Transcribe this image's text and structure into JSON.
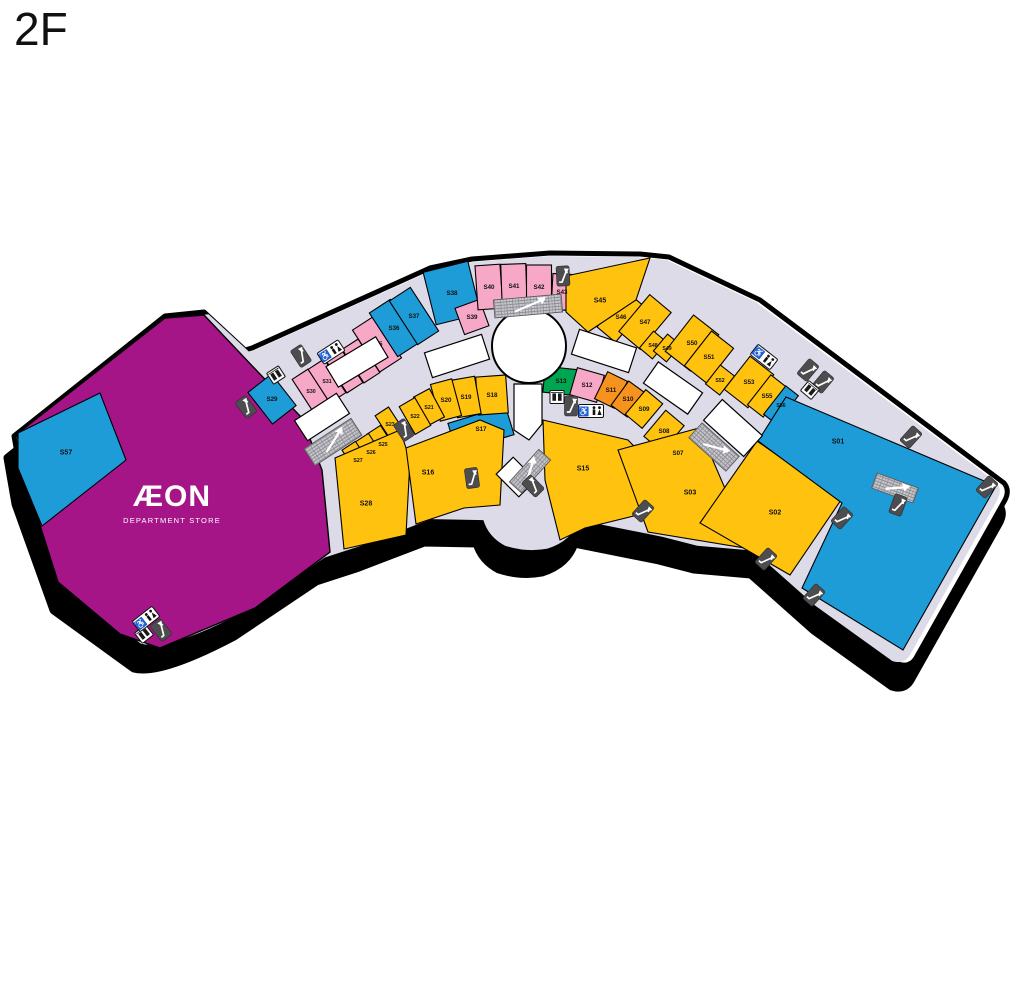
{
  "title": "2F",
  "anchor": {
    "name": "ÆON",
    "subname": "DEPARTMENT STORE",
    "label_x": 172,
    "label_y": 506
  },
  "colors": {
    "anchor": "#A51588",
    "yellow": "#FFC20E",
    "pink": "#F7A8C6",
    "blue": "#1E9CD8",
    "orange": "#F6921E",
    "green": "#00A551",
    "walkway": "#DCDBE7",
    "kiosk": "#FFFFFF",
    "outline": "#000000",
    "icon_dark": "#4D4D4F",
    "hatch_bg": "#C7C7CC",
    "hatch_line": "#8E8E96"
  },
  "outline_path": "M165,316 L204,312 L245,350 L252,348 L390,286 L430,268 L472,259 L550,253 L640,254 L669,257 L760,300 L1004,483 Q1010,490 1005,500 L916,658 Q910,668 898,664 L820,608 L757,552 L700,547 L665,538 L580,521 Q573,542 548,550 Q527,554 505,547 Q488,538 483,521 L430,520 L362,546 L322,559 L240,614 Q166,653 140,646 L60,588 L22,482 L14,436 Z",
  "anchor_poly": "204,315 258,372 302,418 322,470 330,552 255,608 160,648 120,634 58,582 25,478 17,434 165,318",
  "circle": {
    "cx": 529,
    "cy": 346,
    "r": 37
  },
  "shops": [
    {
      "id": "S30",
      "color": "pink",
      "cx": 311,
      "cy": 391,
      "w": 19,
      "h": 40,
      "a": -33
    },
    {
      "id": "S31",
      "color": "pink",
      "cx": 327,
      "cy": 381,
      "w": 19,
      "h": 40,
      "a": -33
    },
    {
      "id": "S32",
      "color": "pink",
      "cx": 344,
      "cy": 371,
      "w": 19,
      "h": 40,
      "a": -33
    },
    {
      "id": "S33",
      "color": "pink",
      "cx": 361,
      "cy": 361,
      "w": 19,
      "h": 40,
      "a": -33
    },
    {
      "id": "S35",
      "color": "pink",
      "cx": 377,
      "cy": 344,
      "w": 26,
      "h": 50,
      "a": -33
    },
    {
      "id": "S36",
      "color": "blue",
      "cx": 394,
      "cy": 328,
      "w": 25,
      "h": 52,
      "a": -33
    },
    {
      "id": "S37",
      "color": "blue",
      "cx": 414,
      "cy": 316,
      "w": 25,
      "h": 52,
      "a": -33
    },
    {
      "id": "S38",
      "color": "blue",
      "cx": 452,
      "cy": 293,
      "w": 46,
      "h": 54,
      "a": -14
    },
    {
      "id": "S39",
      "color": "pink",
      "cx": 472,
      "cy": 317,
      "w": 26,
      "h": 28,
      "a": -20
    },
    {
      "id": "S40",
      "color": "pink",
      "cx": 489,
      "cy": 287,
      "w": 25,
      "h": 44,
      "a": -4
    },
    {
      "id": "S41",
      "color": "pink",
      "cx": 514,
      "cy": 286,
      "w": 25,
      "h": 44,
      "a": -2
    },
    {
      "id": "S42",
      "color": "pink",
      "cx": 539,
      "cy": 287,
      "w": 25,
      "h": 44,
      "a": 0
    },
    {
      "id": "S43",
      "color": "pink",
      "cx": 562,
      "cy": 292,
      "w": 20,
      "h": 36,
      "a": 3
    },
    {
      "id": "S46",
      "color": "yellow",
      "cx": 621,
      "cy": 317,
      "w": 24,
      "h": 46,
      "a": 40
    },
    {
      "id": "S47",
      "color": "yellow",
      "cx": 645,
      "cy": 322,
      "w": 28,
      "h": 48,
      "a": 40
    },
    {
      "id": "S48",
      "color": "yellow",
      "cx": 653,
      "cy": 345,
      "w": 17,
      "h": 22,
      "a": 40
    },
    {
      "id": "S49",
      "color": "yellow",
      "cx": 667,
      "cy": 348,
      "w": 17,
      "h": 22,
      "a": 40
    },
    {
      "id": "S50",
      "color": "yellow",
      "cx": 692,
      "cy": 343,
      "w": 32,
      "h": 46,
      "a": 38
    },
    {
      "id": "S51",
      "color": "yellow",
      "cx": 709,
      "cy": 357,
      "w": 28,
      "h": 44,
      "a": 38
    },
    {
      "id": "S52",
      "color": "yellow",
      "cx": 720,
      "cy": 380,
      "w": 18,
      "h": 24,
      "a": 38
    },
    {
      "id": "S53",
      "color": "yellow",
      "cx": 749,
      "cy": 382,
      "w": 30,
      "h": 42,
      "a": 38
    },
    {
      "id": "S55",
      "color": "yellow",
      "cx": 767,
      "cy": 396,
      "w": 20,
      "h": 38,
      "a": 38
    },
    {
      "id": "S56",
      "color": "blue",
      "cx": 781,
      "cy": 405,
      "w": 16,
      "h": 36,
      "a": 38
    },
    {
      "id": "S13",
      "color": "green",
      "cx": 561,
      "cy": 381,
      "w": 34,
      "h": 26,
      "a": 6
    },
    {
      "id": "S12",
      "color": "pink",
      "cx": 587,
      "cy": 385,
      "w": 28,
      "h": 28,
      "a": 16
    },
    {
      "id": "S11",
      "color": "orange",
      "cx": 611,
      "cy": 390,
      "w": 22,
      "h": 30,
      "a": 26
    },
    {
      "id": "S10",
      "color": "orange",
      "cx": 628,
      "cy": 399,
      "w": 20,
      "h": 30,
      "a": 36
    },
    {
      "id": "S09",
      "color": "yellow",
      "cx": 644,
      "cy": 409,
      "w": 22,
      "h": 32,
      "a": 40
    },
    {
      "id": "S08",
      "color": "yellow",
      "cx": 664,
      "cy": 431,
      "w": 24,
      "h": 34,
      "a": 40
    },
    {
      "id": "S07",
      "color": "yellow",
      "cx": 678,
      "cy": 453,
      "w": 22,
      "h": 32,
      "a": 40
    },
    {
      "id": "S17",
      "color": "blue",
      "cx": 481,
      "cy": 429,
      "w": 60,
      "h": 30,
      "a": -17
    },
    {
      "id": "S18",
      "color": "yellow",
      "cx": 492,
      "cy": 395,
      "w": 30,
      "h": 38,
      "a": -4
    },
    {
      "id": "S19",
      "color": "yellow",
      "cx": 466,
      "cy": 397,
      "w": 24,
      "h": 38,
      "a": -10
    },
    {
      "id": "S20",
      "color": "yellow",
      "cx": 446,
      "cy": 400,
      "w": 22,
      "h": 38,
      "a": -15
    },
    {
      "id": "S21",
      "color": "yellow",
      "cx": 429,
      "cy": 407,
      "w": 18,
      "h": 32,
      "a": -28
    },
    {
      "id": "S22",
      "color": "yellow",
      "cx": 415,
      "cy": 416,
      "w": 18,
      "h": 32,
      "a": -30
    },
    {
      "id": "S23",
      "color": "yellow",
      "cx": 390,
      "cy": 424,
      "w": 16,
      "h": 30,
      "a": -33
    },
    {
      "id": "S25",
      "color": "yellow",
      "cx": 383,
      "cy": 444,
      "w": 16,
      "h": 34,
      "a": -33
    },
    {
      "id": "S26",
      "color": "yellow",
      "cx": 371,
      "cy": 452,
      "w": 16,
      "h": 34,
      "a": -33
    },
    {
      "id": "S27",
      "color": "yellow",
      "cx": 358,
      "cy": 460,
      "w": 16,
      "h": 34,
      "a": -33
    },
    {
      "id": "S29",
      "color": "blue",
      "cx": 272,
      "cy": 399,
      "w": 30,
      "h": 40,
      "a": -38
    },
    {
      "id": "S45",
      "color": "yellow",
      "poly": "566,276 650,258 636,300 588,332 566,312",
      "lx": 600,
      "ly": 300
    },
    {
      "id": "S28",
      "color": "yellow",
      "poly": "335,458 400,430 410,460 406,535 344,549",
      "lx": 366,
      "ly": 503
    },
    {
      "id": "S16",
      "color": "yellow",
      "poly": "406,448 480,420 504,430 500,505 464,508 416,524",
      "lx": 428,
      "ly": 472
    },
    {
      "id": "S15",
      "color": "yellow",
      "poly": "543,420 628,440 655,468 638,515 585,528 560,540 545,480",
      "lx": 583,
      "ly": 468
    },
    {
      "id": "S03",
      "color": "yellow",
      "poly": "618,450 699,428 751,549 648,532",
      "lx": 690,
      "ly": 492
    },
    {
      "id": "S02",
      "color": "yellow",
      "poly": "757,441 841,500 790,575 700,523",
      "lx": 775,
      "ly": 512
    },
    {
      "id": "S01",
      "color": "blue",
      "poly": "786,397 996,486 903,650 802,588 842,503 758,441",
      "lx": 838,
      "ly": 441
    },
    {
      "id": "S57",
      "color": "blue",
      "poly": "18,433 100,393 126,460 42,526 18,468",
      "lx": 66,
      "ly": 452
    }
  ],
  "kiosks": [
    {
      "cx": 322,
      "cy": 417,
      "w": 50,
      "h": 24,
      "a": -33
    },
    {
      "cx": 357,
      "cy": 362,
      "w": 58,
      "h": 24,
      "a": -31
    },
    {
      "cx": 457,
      "cy": 356,
      "w": 60,
      "h": 26,
      "a": -18
    },
    {
      "cx": 604,
      "cy": 351,
      "w": 60,
      "h": 26,
      "a": 18
    },
    {
      "cx": 673,
      "cy": 388,
      "w": 54,
      "h": 26,
      "a": 35
    },
    {
      "cx": 733,
      "cy": 428,
      "w": 54,
      "h": 28,
      "a": 42
    },
    {
      "cx": 516,
      "cy": 477,
      "w": 24,
      "h": 32,
      "a": -45
    },
    {
      "poly": "514,384 542,384 542,424 529,440 514,430"
    }
  ],
  "hatches": [
    {
      "x": 528,
      "y": 306,
      "w": 68,
      "h": 18,
      "a": -5
    },
    {
      "x": 333,
      "y": 442,
      "w": 56,
      "h": 20,
      "a": -33
    },
    {
      "x": 530,
      "y": 471,
      "w": 44,
      "h": 16,
      "a": -48
    },
    {
      "x": 714,
      "y": 447,
      "w": 50,
      "h": 20,
      "a": 42
    },
    {
      "x": 895,
      "y": 488,
      "w": 44,
      "h": 16,
      "a": 20
    }
  ],
  "icons": {
    "escalators": [
      {
        "x": 301,
        "y": 356,
        "a": -33
      },
      {
        "x": 246,
        "y": 407,
        "a": -38
      },
      {
        "x": 563,
        "y": 276,
        "a": -3
      },
      {
        "x": 404,
        "y": 430,
        "a": -33
      },
      {
        "x": 472,
        "y": 478,
        "a": -8
      },
      {
        "x": 571,
        "y": 406,
        "a": 0
      },
      {
        "x": 643,
        "y": 511,
        "a": 42
      },
      {
        "x": 766,
        "y": 559,
        "a": 42
      },
      {
        "x": 808,
        "y": 370,
        "a": 40
      },
      {
        "x": 823,
        "y": 382,
        "a": 40
      },
      {
        "x": 911,
        "y": 437,
        "a": 42
      },
      {
        "x": 987,
        "y": 487,
        "a": 42
      },
      {
        "x": 842,
        "y": 518,
        "a": 42
      },
      {
        "x": 814,
        "y": 595,
        "a": 42
      },
      {
        "x": 898,
        "y": 505,
        "a": 20
      },
      {
        "x": 161,
        "y": 630,
        "a": -38
      },
      {
        "x": 533,
        "y": 486,
        "a": -45
      }
    ],
    "elevators": [
      {
        "x": 276,
        "y": 375,
        "a": -33
      },
      {
        "x": 810,
        "y": 390,
        "a": 40
      },
      {
        "x": 557,
        "y": 397,
        "a": 0
      },
      {
        "x": 144,
        "y": 634,
        "a": -38
      }
    ],
    "restrooms": [
      {
        "x": 331,
        "y": 352,
        "a": -33
      },
      {
        "x": 764,
        "y": 357,
        "a": 38
      },
      {
        "x": 591,
        "y": 411,
        "a": 0
      },
      {
        "x": 146,
        "y": 619,
        "a": -38
      }
    ]
  }
}
